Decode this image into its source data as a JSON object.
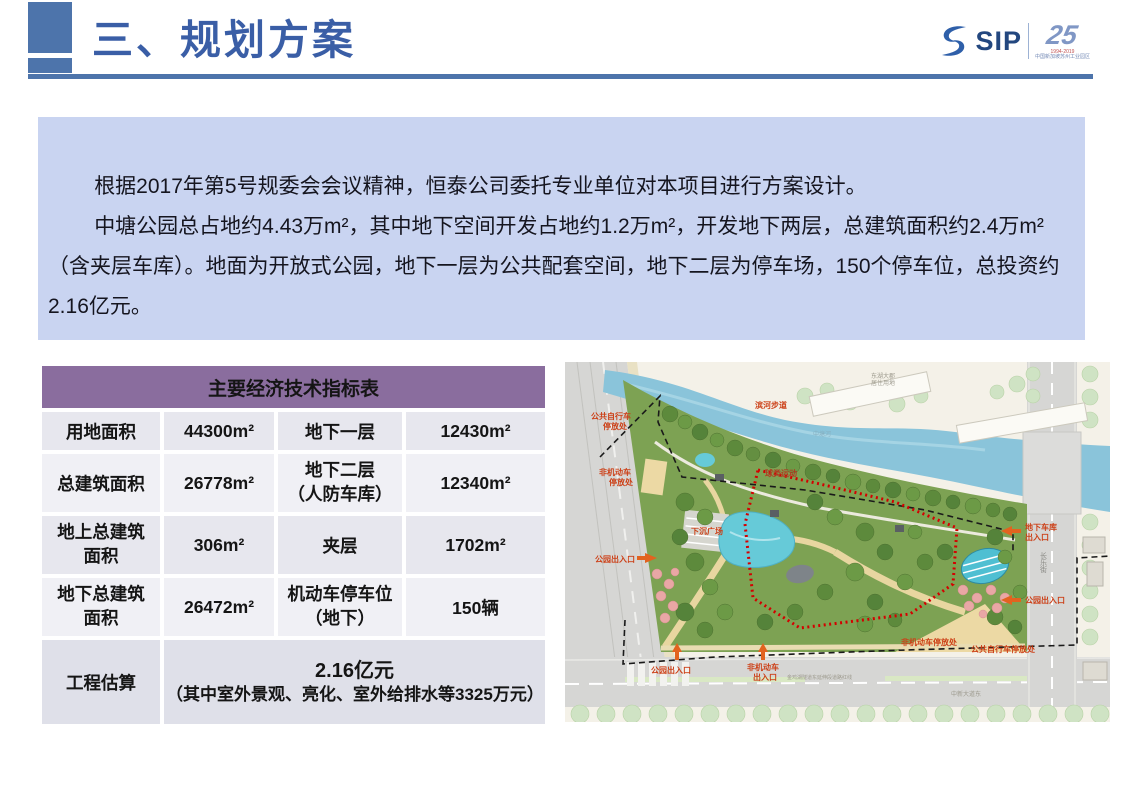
{
  "slide": {
    "title": "三、规划方案",
    "logo": {
      "sip": "SIP",
      "anniv": "25",
      "years": "1994-2019",
      "org": "中国新加坡苏州工业园区"
    }
  },
  "intro": {
    "p1": "根据2017年第5号规委会会议精神，恒泰公司委托专业单位对本项目进行方案设计。",
    "p2": "中塘公园总占地约4.43万m²，其中地下空间开发占地约1.2万m²，开发地下两层，总建筑面积约2.4万m²（含夹层车库）。地面为开放式公园，地下一层为公共配套空间，地下二层为停车场，150个停车位，总投资约2.16亿元。"
  },
  "table": {
    "title": "主要经济技术指标表",
    "rows": [
      {
        "c1": "用地面积",
        "c2": "44300m²",
        "c3": "地下一层",
        "c4": "12430m²"
      },
      {
        "c1": "总建筑面积",
        "c2": "26778m²",
        "c3": [
          "地下二层",
          "（人防车库）"
        ],
        "c4": "12340m²"
      },
      {
        "c1": [
          "地上总建筑",
          "面积"
        ],
        "c2": "306m²",
        "c3": "夹层",
        "c4": "1702m²"
      },
      {
        "c1": [
          "地下总建筑",
          "面积"
        ],
        "c2": "26472m²",
        "c3": [
          "机动车停车位",
          "（地下）"
        ],
        "c4": "150辆"
      }
    ],
    "estimate": {
      "label": "工程估算",
      "value": "2.16亿元",
      "note": "（其中室外景观、亮化、室外给排水等3325万元）"
    }
  },
  "map": {
    "labels": {
      "bike_parking_tl": [
        "公共自行车",
        "停放处"
      ],
      "nonmotor_left": [
        "非机动车",
        "停放处"
      ],
      "riverside": "滨河步道",
      "river_name": "中塘河",
      "donghu": [
        "东湖大郡",
        "居住用地"
      ],
      "ball": "球类运动",
      "sunken": "下沉广场",
      "entry_left": "公园出入口",
      "entry_bottom": "公园出入口",
      "nonmotor_entry": [
        "非机动车",
        "出入口"
      ],
      "nonmotor_br": "非机动车停放处",
      "bike_br": "公共自行车停放处",
      "garage": [
        "地下车库",
        "出入口"
      ],
      "entry_right": "公园出入口",
      "changle": "长乐街",
      "zhongxin": "中新大道东",
      "tunnel": "金鸡湖隧道东延伸段道路红线"
    },
    "colors": {
      "accent_blue": "#4d74ab",
      "title_blue": "#3a5ea6",
      "intro_bg": "#c9d4f1",
      "table_header_purple": "#8a6d9e",
      "boundary_red": "#d40000",
      "map_label_red": "#cc3f16",
      "park_green": "#7da253",
      "river_blue": "#8ac4da"
    }
  }
}
